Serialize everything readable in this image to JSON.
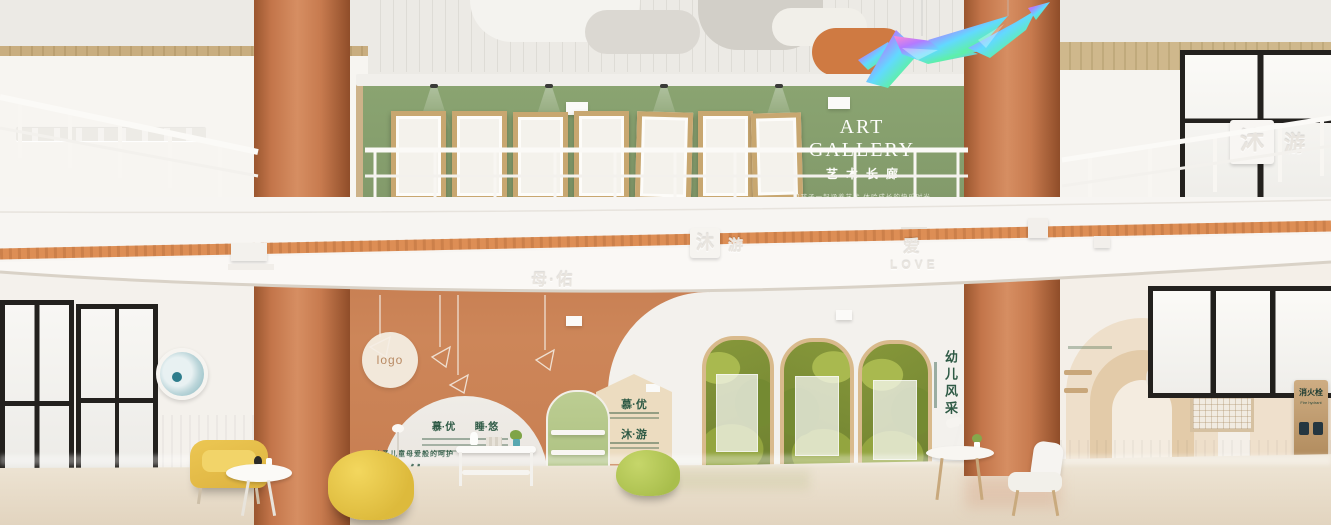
{
  "gallery": {
    "title": "ART GALLERY",
    "subtitle": "艺术长廊",
    "tagline": "和孩子一起涵养艺术 体验成长的快乐时光"
  },
  "fascia": {
    "tile_main": "沐",
    "tile_sub": "游",
    "love_cn": "爱",
    "love_en": "LOVE",
    "brand": "母·佑"
  },
  "balcony_sign": {
    "main": "沐",
    "sub": "游"
  },
  "feature": {
    "logo": "logo",
    "arch_left": "慕·优",
    "arch_right": "睡·悠",
    "house_top": "慕·优",
    "house_bottom": "沐·游",
    "brand_tagline": "给予儿童母爱般的呵护",
    "brand_name": "母·佑"
  },
  "showcase": {
    "vertical": "幼儿风采"
  },
  "fire_sign": {
    "cn": "消火栓",
    "en": "Fire hydrant"
  },
  "palette": {
    "terracotta": "#c77e52",
    "gallery_green": "#87a06c",
    "stripe_orange": "#dd8e55",
    "leaf_green": "#86973a",
    "chair_yellow": "#e5c04a",
    "beanbag_lime": "#b7cb57",
    "door_green": "#b9ca8e",
    "wood": "#c9a87a",
    "floor": "#ebe2d1",
    "sign_green": "#2e5a45"
  }
}
